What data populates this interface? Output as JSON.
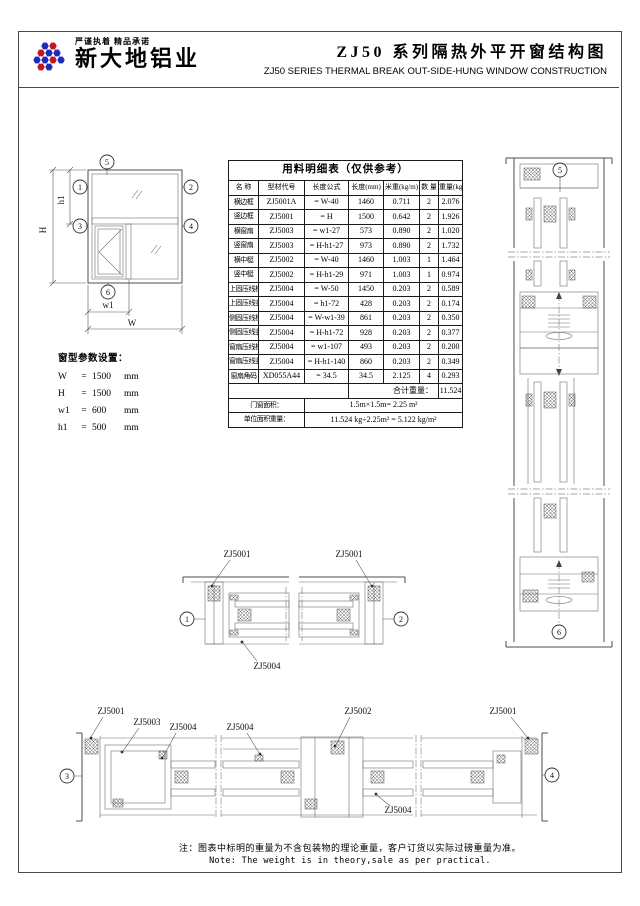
{
  "colors": {
    "logo_blue": "#1c2bbd",
    "logo_red": "#c3161c",
    "line": "#4d4d4d"
  },
  "header": {
    "slogan": "严谨执着 精品承诺",
    "company": "新大地铝业",
    "title_cn": "ZJ50 系列隔热外平开窗结构图",
    "title_en": "ZJ50  SERIES THERMAL BREAK OUT-SIDE-HUNG WINDOW CONSTRUCTION"
  },
  "balloons": [
    "1",
    "2",
    "3",
    "4",
    "5",
    "6"
  ],
  "elevation": {
    "dim_H": "H",
    "dim_h1": "h1",
    "dim_W": "W",
    "dim_w1": "w1"
  },
  "params": {
    "title": "窗型参数设置：",
    "rows": [
      {
        "name": "W",
        "eq": "=",
        "value": "1500",
        "unit": "mm"
      },
      {
        "name": "H",
        "eq": "=",
        "value": "1500",
        "unit": "mm"
      },
      {
        "name": "w1",
        "eq": "=",
        "value": "600",
        "unit": "mm"
      },
      {
        "name": "h1",
        "eq": "=",
        "value": "500",
        "unit": "mm"
      }
    ]
  },
  "table": {
    "title": "用料明细表（仅供参考）",
    "headers": [
      "名 称",
      "型材代号",
      "长度公式",
      "长度(mm)",
      "米重(kg/m)",
      "数 量",
      "重量(kg)"
    ],
    "rows": [
      [
        "横边框",
        "ZJ5001A",
        "= W-40",
        "1460",
        "0.711",
        "2",
        "2.076"
      ],
      [
        "竖边框",
        "ZJ5001",
        "= H",
        "1500",
        "0.642",
        "2",
        "1.926"
      ],
      [
        "横窗扇",
        "ZJ5003",
        "= w1-27",
        "573",
        "0.890",
        "2",
        "1.020"
      ],
      [
        "竖窗扇",
        "ZJ5003",
        "= H-h1-27",
        "973",
        "0.890",
        "2",
        "1.732"
      ],
      [
        "横中梃",
        "ZJ5002",
        "= W-40",
        "1460",
        "1.003",
        "1",
        "1.464"
      ],
      [
        "竖中梃",
        "ZJ5002",
        "= H-h1-29",
        "971",
        "1.003",
        "1",
        "0.974"
      ],
      [
        "上固压线横",
        "ZJ5004",
        "= W-50",
        "1450",
        "0.203",
        "2",
        "0.589"
      ],
      [
        "上固压线竖",
        "ZJ5004",
        "= h1-72",
        "428",
        "0.203",
        "2",
        "0.174"
      ],
      [
        "侧固压线横",
        "ZJ5004",
        "= W-w1-39",
        "861",
        "0.203",
        "2",
        "0.350"
      ],
      [
        "侧固压线竖",
        "ZJ5004",
        "= H-h1-72",
        "928",
        "0.203",
        "2",
        "0.377"
      ],
      [
        "窗扇压线横",
        "ZJ5004",
        "= w1-107",
        "493",
        "0.203",
        "2",
        "0.200"
      ],
      [
        "窗扇压线竖",
        "ZJ5004",
        "= H-h1-140",
        "860",
        "0.203",
        "2",
        "0.349"
      ],
      [
        "窗扇角码",
        "XD055A44",
        "= 34.5",
        "34.5",
        "2.125",
        "4",
        "0.293"
      ]
    ],
    "total_label": "合计重量：",
    "total_value": "11.524",
    "area_label": "门窗面积：",
    "area_value": "1.5m×1.5m= 2.25 m²",
    "unit_label": "单位面积重量：",
    "unit_value": "11.524 kg÷2.25m² = 5.122 kg/m²"
  },
  "sections": {
    "mid": {
      "left_label": "ZJ5001",
      "right_label": "ZJ5001",
      "bottom_label": "ZJ5004"
    },
    "bottom": {
      "l1": "ZJ5001",
      "l2": "ZJ5003",
      "l3": "ZJ5004",
      "l4": "ZJ5004",
      "l5": "ZJ5002",
      "l6": "ZJ5001",
      "l7": "ZJ5004"
    }
  },
  "note": {
    "cn": "注：图表中标明的重量为不含包装物的理论重量，客户订货以实际过磅重量为准。",
    "en": "Note: The weight is in theory,sale as per practical."
  }
}
